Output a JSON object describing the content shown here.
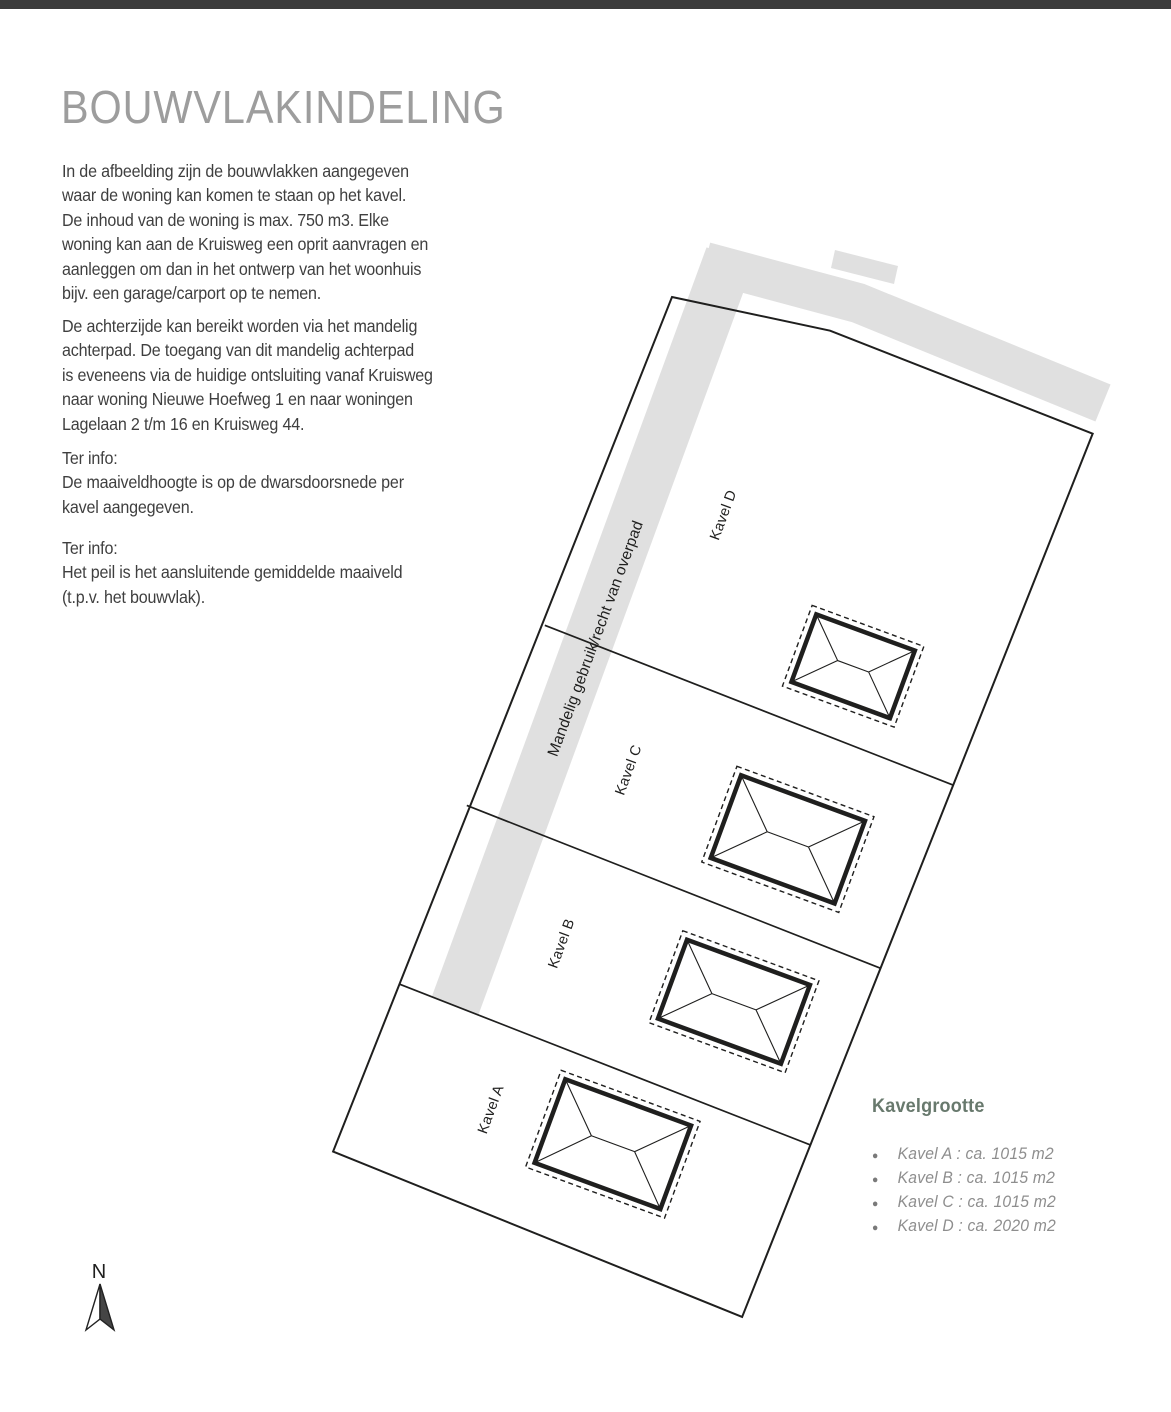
{
  "page": {
    "title": "BOUWVLAKINDELING",
    "paragraph1": "In de afbeelding zijn de bouwvlakken aangegeven\nwaar de woning kan komen te staan op het kavel.\nDe inhoud van de woning is max. 750 m3. Elke\nwoning kan aan de Kruisweg een oprit aanvragen en\naanleggen om dan in het ontwerp van het woonhuis\nbijv. een garage/carport op te nemen.",
    "paragraph2": "De achterzijde kan bereikt worden via het mandelig\nachterpad. De toegang van dit mandelig achterpad\nis eveneens via de huidige ontsluiting vanaf Kruisweg\nnaar woning Nieuwe Hoefweg 1 en naar woningen\nLagelaan 2 t/m 16 en Kruisweg 44.",
    "info1": "Ter info:\nDe maaiveldhoogte is op de dwarsdoorsnede per\nkavel aangegeven.",
    "info2": "Ter info:\nHet peil is het aansluitende gemiddelde maaiveld\n(t.p.v. het bouwvlak)."
  },
  "plan": {
    "parcels": [
      {
        "id": "A",
        "label": "Kavel A"
      },
      {
        "id": "B",
        "label": "Kavel B"
      },
      {
        "id": "C",
        "label": "Kavel C"
      },
      {
        "id": "D",
        "label": "Kavel D"
      }
    ],
    "path_label": "Mandelig gebruik/recht van overpad",
    "north_label": "N"
  },
  "legend": {
    "heading": "Kavelgrootte",
    "items": [
      "Kavel A : ca. 1015 m2",
      "Kavel B : ca. 1015 m2",
      "Kavel C : ca. 1015 m2",
      "Kavel D : ca. 2020 m2"
    ]
  },
  "colors": {
    "accent_bar": "#3b3b3b",
    "title": "#9d9d9d",
    "body_text": "#3f3f3f",
    "legend_heading": "#68796d",
    "legend_item": "#8e8e8e",
    "line": "#1f1f1e",
    "area_gray": "#e0e0e0"
  }
}
